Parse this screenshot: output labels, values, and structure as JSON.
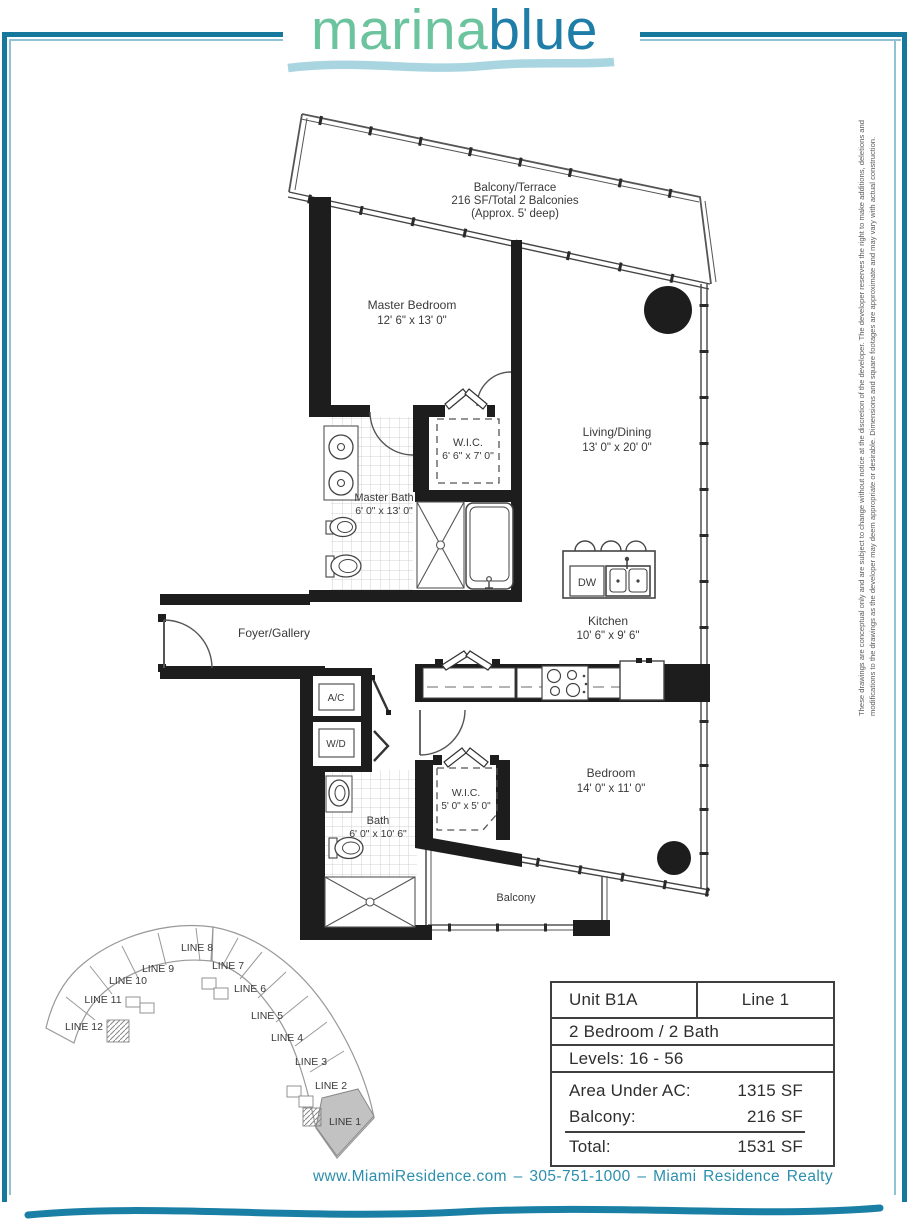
{
  "logo": {
    "part1": "marina",
    "part2": "blue"
  },
  "plan": {
    "balcony_terrace": {
      "name": "Balcony/Terrace",
      "line2": "216 SF/Total 2 Balconies",
      "line3": "(Approx. 5' deep)"
    },
    "master_bedroom": {
      "name": "Master Bedroom",
      "dims": "12' 6\" x 13' 0\""
    },
    "master_wic": {
      "name": "W.I.C.",
      "dims": "6' 6\" x 7' 0\""
    },
    "master_bath": {
      "name": "Master Bath",
      "dims": "6' 0\" x 13' 0\""
    },
    "living_dining": {
      "name": "Living/Dining",
      "dims": "13' 0\" x 20' 0\""
    },
    "kitchen": {
      "name": "Kitchen",
      "dims": "10' 6\" x 9' 6\""
    },
    "foyer": {
      "name": "Foyer/Gallery"
    },
    "ac_closet": {
      "name": "A/C"
    },
    "wd_closet": {
      "name": "W/D"
    },
    "dishwasher": {
      "name": "DW"
    },
    "bath2": {
      "name": "Bath",
      "dims": "6' 0\" x 10' 6\""
    },
    "wic2": {
      "name": "W.I.C.",
      "dims": "5' 0\" x 5' 0\""
    },
    "bedroom2": {
      "name": "Bedroom",
      "dims": "14' 0\" x 11' 0\""
    },
    "balcony2": {
      "name": "Balcony"
    }
  },
  "keyplan": {
    "highlighted": "LINE 1",
    "lines": [
      {
        "label": "LINE 1"
      },
      {
        "label": "LINE 2"
      },
      {
        "label": "LINE 3"
      },
      {
        "label": "LINE 4"
      },
      {
        "label": "LINE 5"
      },
      {
        "label": "LINE 6"
      },
      {
        "label": "LINE 7"
      },
      {
        "label": "LINE 8"
      },
      {
        "label": "LINE 9"
      },
      {
        "label": "LINE 10"
      },
      {
        "label": "LINE 11"
      },
      {
        "label": "LINE 12"
      }
    ]
  },
  "table": {
    "unit": "Unit B1A",
    "line": "Line 1",
    "bedbath": "2 Bedroom / 2 Bath",
    "levels": "Levels: 16 - 56",
    "area_label": "Area Under AC:",
    "area_value": "1315 SF",
    "balcony_label": "Balcony:",
    "balcony_value": "216 SF",
    "total_label": "Total:",
    "total_value": "1531 SF"
  },
  "footer": {
    "text": "www.MiamiResidence.com  –  305-751-1000  –  Miami Residence Realty"
  },
  "disclaimer": {
    "line1": "These drawings are conceptual only and are subject to change without notice at the discretion of the developer. The developer reserves the right to make additions, deletions and",
    "line2": "modifications to the drawings as the developer may deem appropriate or desirable. Dimensions and square footages are approximate and may vary with actual construction."
  },
  "colors": {
    "frame_dark": "#17789d",
    "frame_light": "#8fc2d4",
    "logo_green": "#6bc49e",
    "logo_blue": "#1e7ea7",
    "logo_wave": "#a9d5e0",
    "footer_teal": "#2b8fad",
    "keyplan_highlight": "#c2c2c2",
    "wall_black": "#1d1d1d"
  }
}
